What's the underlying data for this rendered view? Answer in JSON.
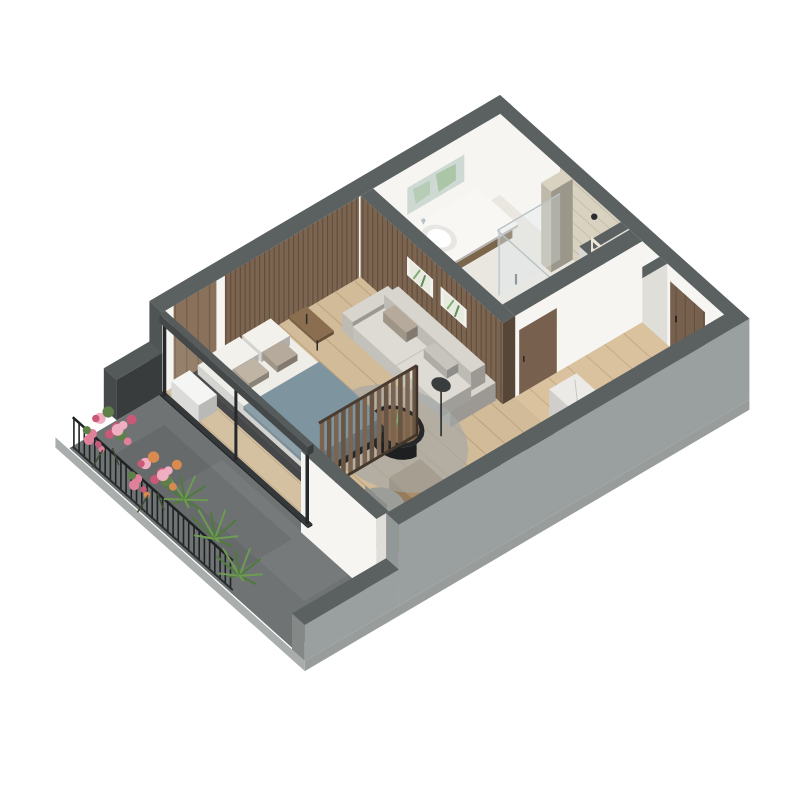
{
  "meta": {
    "scene": "3D isometric cutaway floor plan of a studio apartment with balcony"
  },
  "palette": {
    "bg": "#ffffff",
    "wallTop": "#5b6061",
    "wallWhite": "#f6f5f2",
    "wallWhiteShade": "#e0ded8",
    "extLight": "#9aa09f",
    "extMid": "#8f9594",
    "extDark": "#4f5455",
    "slab": "#a9aead",
    "woodFloor": "#d2bb98",
    "woodFloorLine": "#b39a76",
    "balconyFloor": "#6f7374",
    "bathFloor": "#eae7e0",
    "slatWood": "#7b6450",
    "plankWood": "#8a715b",
    "travertine": "#d9d2c1",
    "doorWood": "#77614e",
    "counterWood": "#ab8d68",
    "marble": "#eceae6",
    "gloss": "#17191a",
    "white": "#f8f7f4",
    "sofa": "#d8d5ce",
    "pillowTaupe": "#b5aa9b",
    "bedWhite": "#efede8",
    "blanket": "#7e949f",
    "bedFrame": "#353638",
    "rug": "#a3a7a6",
    "tableBlack": "#262829",
    "tray": "#8a6e4f",
    "glassFrame": "#26292a",
    "railing": "#1f2324",
    "flowerPink": "#e0809b",
    "flowerDeep": "#c95977",
    "flowerLight": "#efaec2",
    "flowerOrange": "#d98a4f",
    "leaf": "#5f8048",
    "spiky": "#6d9b52",
    "spikyDark": "#4f7a3c",
    "chrome": "#b9c2c4",
    "mirror": "#cfd9d3",
    "mirrorPlant": "#7fae72",
    "chair": "#9b9e99"
  },
  "rooms": [
    {
      "name": "bathroom",
      "furniture": [
        "vanity with basin and faucet",
        "mirror with plant reflection",
        "walk-in glass shower",
        "travertine wall",
        "toilet",
        "towel ladder"
      ]
    },
    {
      "name": "entry-hall",
      "furniture": [
        "wood entry door",
        "marble-top washer cabinet",
        "utility shaft"
      ]
    },
    {
      "name": "kitchen",
      "furniture": [
        "tall marble cabinet",
        "black glossy counters",
        "wood bar block",
        "low black cabinet"
      ]
    },
    {
      "name": "living-sleeping-area",
      "furniture": [
        "sofa with pillows",
        "two framed botanical prints",
        "round grey rug",
        "black coffee table with plant",
        "floor lamp",
        "wood side bench",
        "slatted wood partition",
        "double bed with blue-grey blanket",
        "white nightstand",
        "desk console with chair and dried plant"
      ]
    },
    {
      "name": "balcony",
      "furniture": [
        "glass sliding wall with black frame",
        "black railing",
        "pink flower boxes",
        "green spiky plants",
        "dark stone floor",
        "grey parapet"
      ]
    }
  ]
}
